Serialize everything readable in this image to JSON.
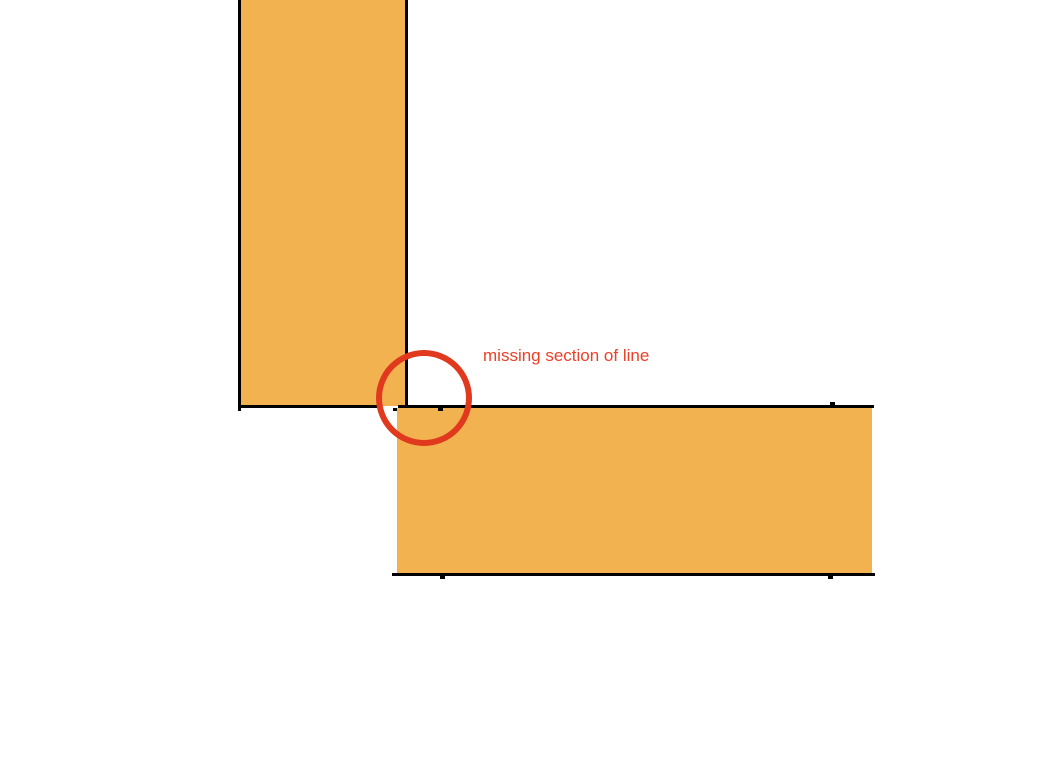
{
  "page": {
    "background": "#ffffff",
    "width": 1064,
    "height": 768
  },
  "colors": {
    "rect_fill": "#f2b24f",
    "rect_line": "#000000",
    "annotation_red": "#e0391d",
    "label_red": "#ee4028"
  },
  "annotation": {
    "label": "missing section of line"
  },
  "geometry": {
    "vertical_rect_fill": {
      "left": 240,
      "top": 0,
      "width": 166,
      "height": 406
    },
    "vertical_rect_left_border": {
      "left": 238,
      "top": 0,
      "width": 3,
      "height": 411
    },
    "vertical_rect_right_border": {
      "left": 405,
      "top": 0,
      "width": 3,
      "height": 405
    },
    "vertical_rect_bottom_border_partial": {
      "left": 238,
      "top": 405,
      "width": 139,
      "height": 3
    },
    "horizontal_rect_fill": {
      "left": 397,
      "top": 408,
      "width": 475,
      "height": 165
    },
    "horizontal_rect_top_border": {
      "left": 398,
      "top": 405,
      "width": 476,
      "height": 3
    },
    "horizontal_rect_bottom_border": {
      "left": 392,
      "top": 573,
      "width": 483,
      "height": 3
    },
    "tick_top_line_start": {
      "left": 393,
      "top": 408,
      "width": 4,
      "height": 3
    },
    "tick_top_line_mid": {
      "left": 438,
      "top": 408,
      "width": 5,
      "height": 3
    },
    "tick_top_line_right": {
      "left": 830,
      "top": 402,
      "width": 5,
      "height": 3
    },
    "tick_bottom_line_mid": {
      "left": 440,
      "top": 576,
      "width": 5,
      "height": 3
    },
    "tick_bottom_line_right": {
      "left": 828,
      "top": 576,
      "width": 5,
      "height": 3
    },
    "highlight_circle": {
      "left": 376,
      "top": 350,
      "width": 84,
      "height": 84,
      "stroke": 6
    },
    "annotation_label": {
      "left": 483,
      "top": 346
    }
  }
}
